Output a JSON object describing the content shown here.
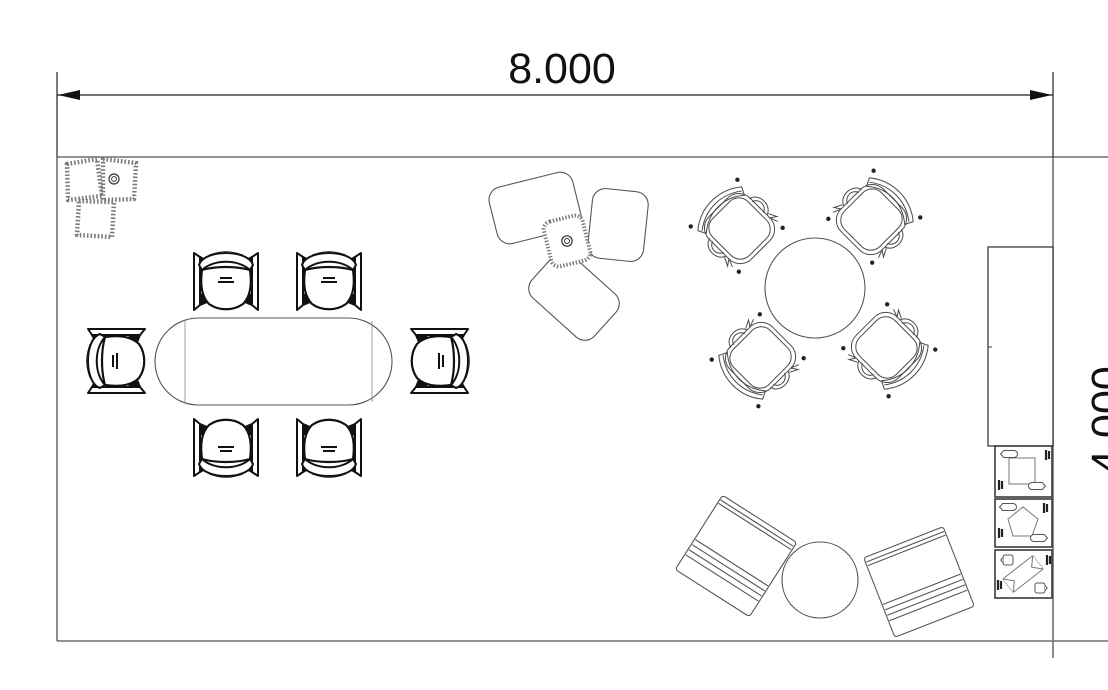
{
  "drawing": {
    "kind": "office-floor-plan",
    "background": "#ffffff",
    "dimensions": {
      "width_label": "8.000",
      "height_label": "4.000"
    },
    "colors": {
      "wall_line": "#6e6e6e",
      "furniture_line": "#555555",
      "chair_line": "#111111",
      "dimension_line": "#222222",
      "soft_seating_edge": "#7a7a7a"
    },
    "furniture": [
      {
        "label": "corner pouf seating",
        "quantity": 3
      },
      {
        "label": "conference table (racetrack)",
        "quantity": 1
      },
      {
        "label": "conference chair",
        "quantity": 6
      },
      {
        "label": "lounge seat with side table",
        "quantity": 3
      },
      {
        "label": "round meeting table",
        "quantity": 1
      },
      {
        "label": "armchair",
        "quantity": 4
      },
      {
        "label": "tall cabinet",
        "quantity": 1
      },
      {
        "label": "recycling bin module",
        "quantity": 3
      },
      {
        "label": "lounge armchair (square)",
        "quantity": 2
      },
      {
        "label": "round coffee table",
        "quantity": 2
      }
    ]
  }
}
